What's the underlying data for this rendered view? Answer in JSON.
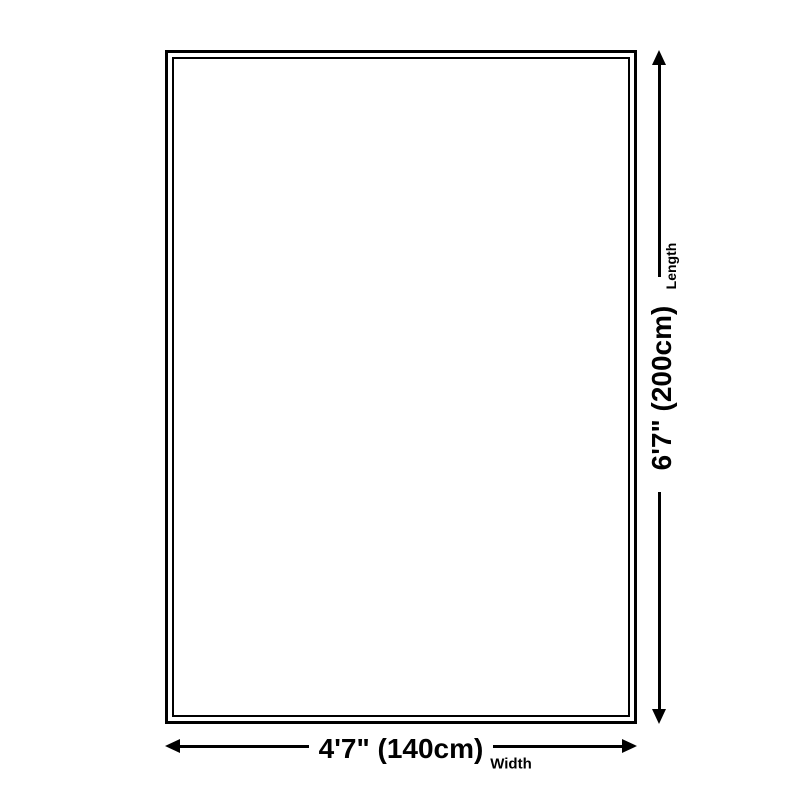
{
  "diagram": {
    "type": "product-size-diagram",
    "background_color": "#ffffff",
    "line_color": "#000000",
    "shape": "rectangle-double-border",
    "dimensions": {
      "length": {
        "value": "6'7\" (200cm)",
        "label": "Length",
        "orientation": "vertical",
        "arrows": [
          "up",
          "down"
        ]
      },
      "width": {
        "value": "4'7\" (140cm)",
        "label": "Width",
        "orientation": "horizontal",
        "arrows": [
          "left",
          "right"
        ]
      }
    }
  }
}
